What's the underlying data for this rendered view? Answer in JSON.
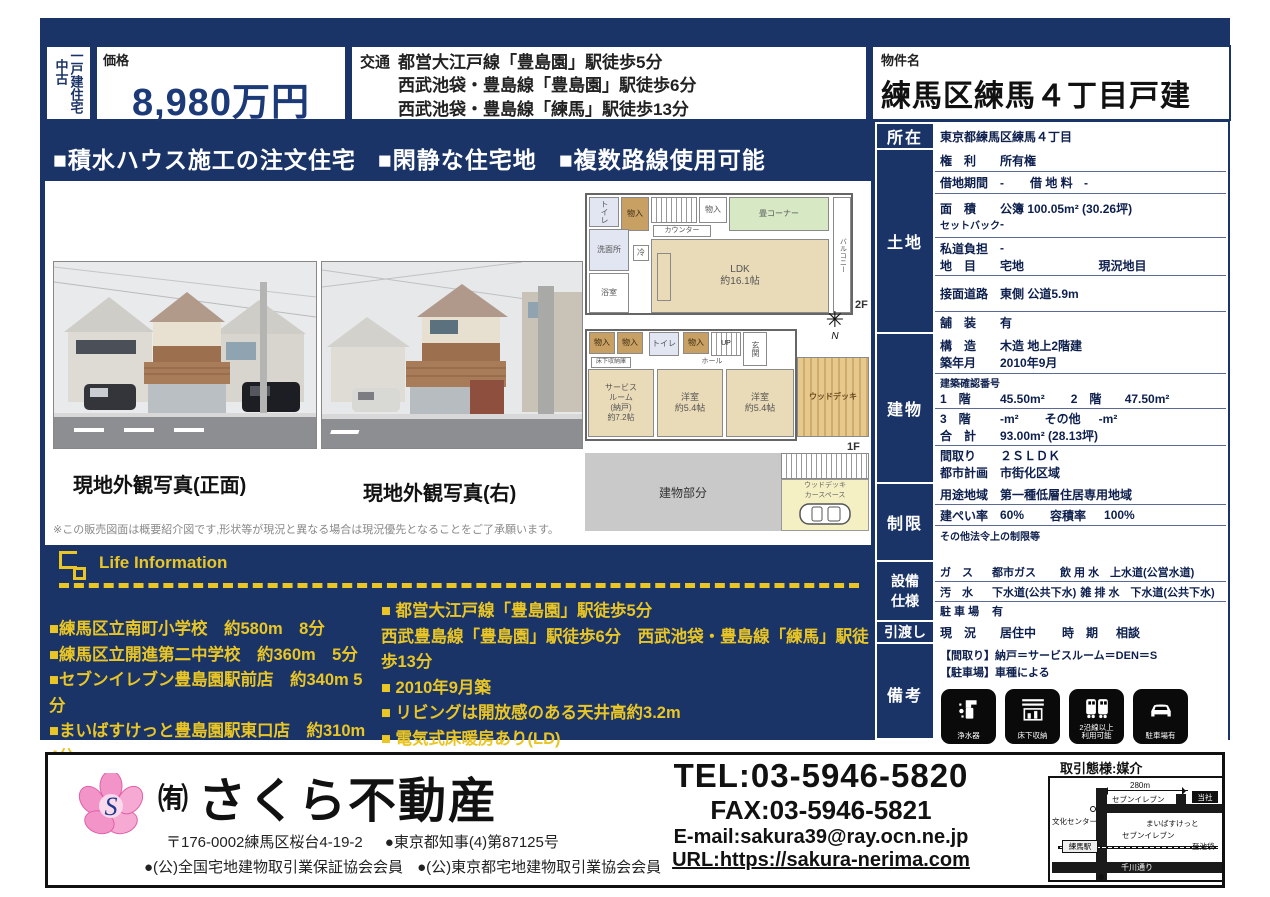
{
  "header": {
    "category_used": "中古",
    "category_type": "一戸建住宅",
    "price_label": "価格",
    "price_value": "8,980万円",
    "access_label": "交通",
    "access_line1": "都営大江戸線「豊島園」駅徒歩5分",
    "access_line2": "西武池袋・豊島線「豊島園」駅徒歩6分",
    "access_line3": "西武池袋・豊島線「練馬」駅徒歩13分",
    "property_label": "物件名",
    "property_name": "練馬区練馬４丁目戸建"
  },
  "banner": {
    "item1": "■積水ハウス施工の注文住宅",
    "item2": "■閑静な住宅地",
    "item3": "■複数路線使用可能"
  },
  "photos": {
    "caption_front": "現地外観写真(正面)",
    "caption_right": "現地外観写真(右)",
    "disclaimer": "※この販売図面は概要紹介図です,形状等が現況と異なる場合は現況優先となることをご了承願います。"
  },
  "floorplan": {
    "f2": {
      "toilet": "トイレ",
      "closet": "物入",
      "closet2": "物入",
      "washroom": "洗面所",
      "bath": "浴室",
      "fridge": "冷",
      "counter": "カウンター",
      "tatami": "畳コーナー",
      "ldk": "LDK\n約16.1帖",
      "balcony": "バルコニー",
      "label": "2F"
    },
    "f1": {
      "closet1": "物入",
      "closet2": "物入",
      "toilet": "トイレ",
      "closet3": "物入",
      "entrance": "玄関",
      "up": "UP",
      "hall": "ホール",
      "underfloor": "床下収納庫",
      "service": "サービス\nルーム\n(納戸)\n約7.2帖",
      "room1": "洋室\n約5.4帖",
      "room2": "洋室\n約5.4帖",
      "wooddeck": "ウッドデッキ",
      "label": "1F"
    },
    "site": {
      "building": "建物部分",
      "deck": "ウッドデッキ",
      "car": "カースペース"
    },
    "compass_n": "N",
    "compass_star": "✳"
  },
  "spec": {
    "shozai": {
      "label": "所在",
      "value": "東京都練馬区練馬４丁目"
    },
    "tochi": {
      "label": "土地",
      "kenri_k": "権　利",
      "kenri_v": "所有権",
      "shakuchi_k": "借地期間",
      "shakuchi_v": "-",
      "shakuchiryo_k": "借 地 料",
      "shakuchiryo_v": "-",
      "menseki_k": "面　積",
      "menseki_v": "公簿 100.05m² (30.26坪)",
      "setback_k": "セットバック",
      "setback_v": "-",
      "shido_k": "私道負担",
      "shido_v": "-",
      "chimoku_k": "地　目",
      "chimoku_v": "宅地",
      "genkyo_chimoku": "現況地目",
      "setsumen_k": "接面道路",
      "setsumen_v": "東側 公道5.9m",
      "hoso_k": "舗　装",
      "hoso_v": "有"
    },
    "tatemono": {
      "label": "建物",
      "kozo_k": "構　造",
      "kozo_v": "木造 地上2階建",
      "chiku_k": "築年月",
      "chiku_v": "2010年9月",
      "kakunin_k": "建築確認番号",
      "f1_k": "1　階",
      "f1_v": "45.50m²",
      "f2_k": "2　階",
      "f2_v": "47.50m²",
      "f3_k": "3　階",
      "f3_v": "-m²",
      "other_k": "その他",
      "other_v": "-m²",
      "total_k": "合　計",
      "total_v": "93.00m² (28.13坪)",
      "madori_k": "間取り",
      "madori_v": "２ＳＬＤＫ",
      "toshi_k": "都市計画",
      "toshi_v": "市街化区域"
    },
    "seigen": {
      "label": "制限",
      "yoto_k": "用途地域",
      "yoto_v": "第一種低層住居専用地域",
      "kenpei_k": "建ぺい率",
      "kenpei_v": "60%",
      "yoseki_k": "容積率",
      "yoseki_v": "100%",
      "sonota_k": "その他法令上の制限等"
    },
    "setsubi": {
      "label": "設備\n仕様",
      "gas_k": "ガ　ス",
      "gas_v": "都市ガス",
      "inyo_k": "飲 用 水",
      "inyo_v": "上水道(公営水道)",
      "osui_k": "汚　水",
      "osui_v": "下水道(公共下水)",
      "zappai_k": "雑 排 水",
      "zappai_v": "下水道(公共下水)",
      "parking_k": "駐 車 場",
      "parking_v": "有"
    },
    "hikiwatashi": {
      "label": "引渡し",
      "genkyo_k": "現　況",
      "genkyo_v": "居住中",
      "jiki_k": "時　期",
      "jiki_v": "相談"
    },
    "biko": {
      "label": "備考",
      "line1": "【間取り】納戸＝サービスルーム＝DEN＝S",
      "line2": "【駐車場】車種による",
      "icon1": "浄水器",
      "icon2": "床下収納",
      "icon3": "2沿線以上\n利用可能",
      "icon4": "駐車場有"
    }
  },
  "life": {
    "title": "Life Information",
    "left1": "■練馬区立南町小学校　約580m　8分",
    "left2": "■練馬区立開進第二中学校　約360m　5分",
    "left3": "■セブンイレブン豊島園駅前店　約340m 5分",
    "left4": "■まいばすけっと豊島園駅東口店　約310m　4分",
    "right1": "■ 都営大江戸線「豊島園」駅徒歩5分",
    "right2": "西武豊島線「豊島園」駅徒歩6分　西武池袋・豊島線「練馬」駅徒歩13分",
    "right3": "■ 2010年9月築",
    "right4": "■ リビングは開放感のある天井高約3.2m",
    "right5": "■ 電気式床暖房あり(LD)",
    "right6": "■ カースペース有"
  },
  "footer": {
    "company_prefix": "㈲",
    "company_name": "さくら不動産",
    "logo_letter": "S",
    "address": "〒176-0002練馬区桜台4-19-2",
    "license": "●東京都知事(4)第87125号",
    "member1": "●(公)全国宅地建物取引業保証協会会員",
    "member2": "●(公)東京都宅地建物取引業協会会員",
    "tel": "TEL:03-5946-5820",
    "fax": "FAX:03-5946-5821",
    "email": "E-mail:sakura39@ray.ocn.ne.jp",
    "url": "URL:https://sakura-nerima.com",
    "deal_type": "取引態様:媒介",
    "map": {
      "scale": "280m",
      "seven1": "セブンイレブン",
      "tosha": "当社",
      "bunka": "文化センター",
      "maibasuketto": "まいばすけっと",
      "seven2": "セブンイレブン",
      "station": "練馬駅",
      "ikebukuro": "至池袋",
      "senkawa": "千川通り"
    }
  }
}
